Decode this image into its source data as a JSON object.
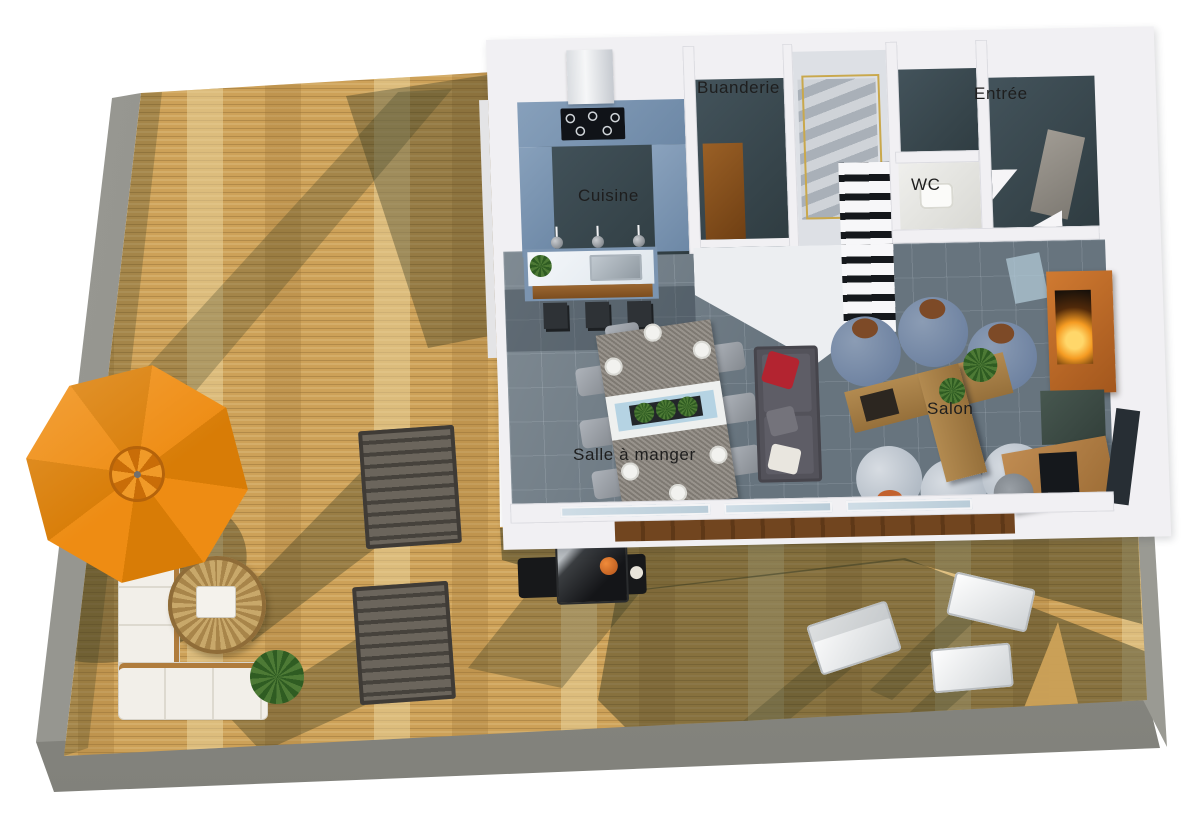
{
  "scene": {
    "type": "3d-floor-plan-render",
    "description": "Top-down 3D render of a house ground floor with a large wooden deck terrace",
    "background_color": "#ffffff"
  },
  "room_labels": {
    "buanderie": "Buanderie",
    "entree": "Entrée",
    "wc": "WC",
    "cuisine": "Cuisine",
    "salle_a_manger": "Salle à manger",
    "salon": "Salon"
  },
  "palette": {
    "deck_wood": "#cda158",
    "deck_wood_light": "#e0c791",
    "deck_shadow_olive": "#5d5c40",
    "concrete_border": "#8d8d86",
    "wall_white": "#f1f0f3",
    "tile_floor_blue_gray": "#67747e",
    "dark_floor": "#36444a",
    "counter_blue": "#7b94b0",
    "island_top_white": "#eef2f5",
    "umbrella_orange": "#e8860f",
    "armchair_blue": "#7589a5",
    "armchair_light": "#bcc4cd",
    "sofa_gray": "#53525a",
    "pillow_red": "#b32430",
    "coffee_table_wood": "#a87c45",
    "fireplace_wood": "#c06b28",
    "flame_gold": "#f5a93b",
    "railing_gold": "#c9a84c",
    "lounger_gray_brown": "#5f594f",
    "outdoor_sofa_white": "#f2efe9",
    "rattan_tan": "#c8a86a",
    "plant_green": "#4d7a35",
    "label_text": "#1e1e1e"
  },
  "deck_furniture": [
    "parasol",
    "outdoor-sectional-sofa",
    "rattan-coffee-table",
    "potted-plant",
    "sun-lounger",
    "sun-lounger",
    "barbecue-grill",
    "folding-deck-chair",
    "folding-deck-chair",
    "folding-deck-chair"
  ],
  "interior_furniture": {
    "cuisine": [
      "range-hood",
      "cooktop",
      "u-shaped-counter",
      "kitchen-island",
      "sink",
      "pendant-lights",
      "bar-stool",
      "bar-stool",
      "bar-stool"
    ],
    "salle_a_manger": [
      "dining-table",
      "dining-chairs-x8",
      "plates",
      "planter-centerpiece"
    ],
    "salon": [
      "sofa",
      "armchair-x6",
      "t-shaped-coffee-table",
      "fireplace",
      "desk",
      "desk-chair",
      "monitor"
    ],
    "circulation": [
      "staircase",
      "gold-railing"
    ]
  }
}
